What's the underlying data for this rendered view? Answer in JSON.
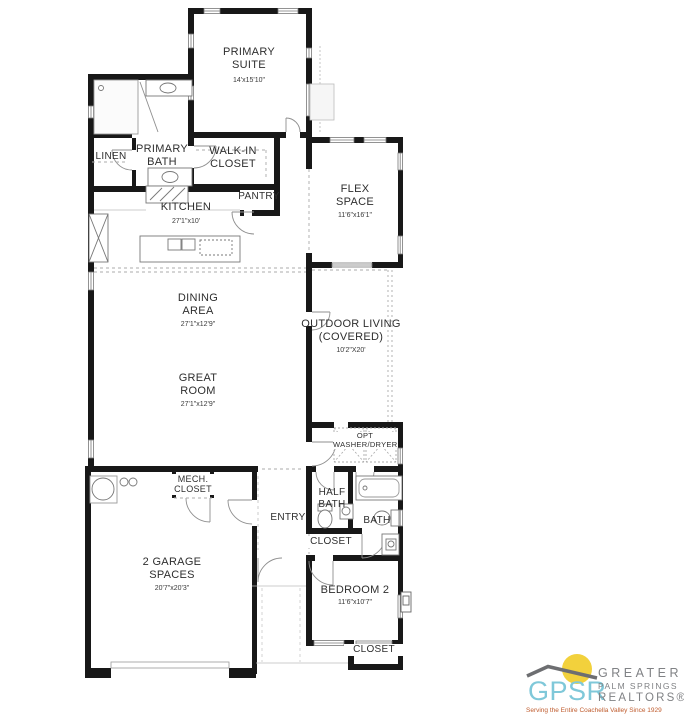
{
  "rooms": [
    {
      "name": "PRIMARY SUITE",
      "dims": "14'x15'10\""
    },
    {
      "name": "LINEN"
    },
    {
      "name": "PRIMARY BATH"
    },
    {
      "name": "WALK-IN CLOSET"
    },
    {
      "name": "PANTRY"
    },
    {
      "name": "KITCHEN",
      "dims": "27'1\"x10'"
    },
    {
      "name": "FLEX SPACE",
      "dims": "11'6\"x16'1\""
    },
    {
      "name": "DINING AREA",
      "dims": "27'1\"x12'9\""
    },
    {
      "name": "GREAT ROOM",
      "dims": "27'1\"x12'9\""
    },
    {
      "name": "OUTDOOR LIVING (COVERED)",
      "dims": "10'2\"X20'"
    },
    {
      "name": "OPT WASHER/DRYER"
    },
    {
      "name": "MECH. CLOSET"
    },
    {
      "name": "ENTRY"
    },
    {
      "name": "HALF BATH"
    },
    {
      "name": "BATH"
    },
    {
      "name": "CLOSET"
    },
    {
      "name": "2 GARAGE SPACES",
      "dims": "20'7\"x20'3\""
    },
    {
      "name": "BEDROOM 2",
      "dims": "11'6\"x10'7\""
    },
    {
      "name": "CLOSET"
    }
  ],
  "logo": {
    "acronym": "GPSR",
    "org_line1": "GREATER",
    "org_line2": "PALM SPRINGS",
    "org_line3": "REALTORS®",
    "tagline": "Serving the Entire Coachella Valley Since 1929",
    "colors": {
      "acronym": "#7fc8d9",
      "org": "#808285",
      "tagline": "#bf5b2d",
      "sun": "#f2d13c",
      "mountain": "#6d6e71"
    }
  }
}
